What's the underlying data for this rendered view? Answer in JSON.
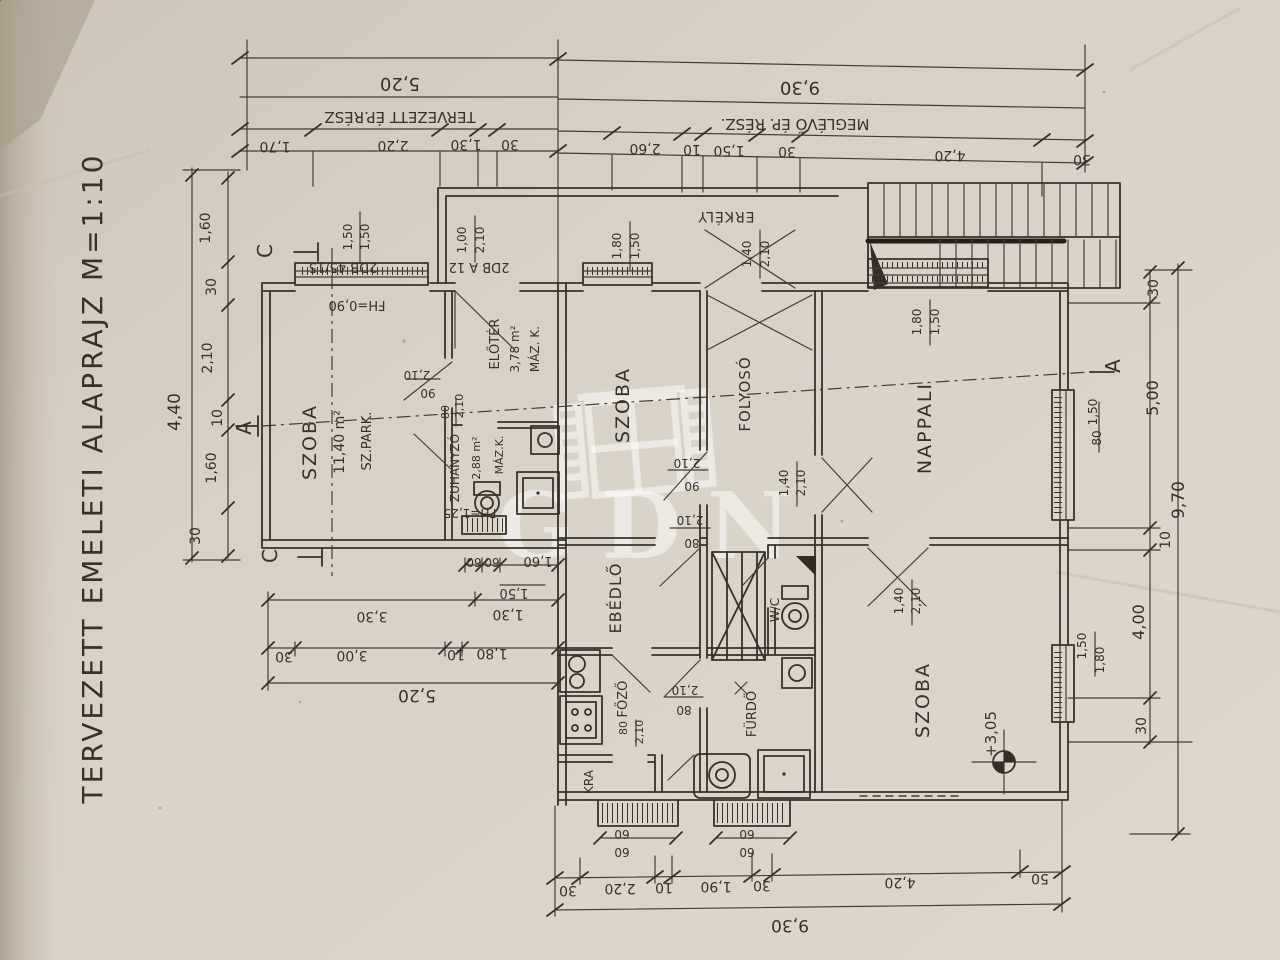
{
  "photo": {
    "title": "TERVEZETT EMELETI ALAPRAJZ M=1:10",
    "watermark_text": "GDN",
    "ink_color": "#38312a",
    "paper_color": "#d8d1c6"
  },
  "plan_summary": {
    "drawing_title": "TERVEZETT EMELETI ALAPRAJZ",
    "scale": "M=1:10",
    "building_sections": {
      "new": "TERVEZETT ÉP.RÉSZ",
      "existing": "MEGLÉVŐ ÉP. RÉSZ."
    },
    "rooms": [
      {
        "name": "SZOBA",
        "area": "11,40 m²",
        "floor": "SZ.PARK."
      },
      {
        "name": "ELŐTÉR",
        "area": "3,78 m²",
        "floor": "MÁZ. K."
      },
      {
        "name": "ZUHANYZÓ",
        "area": "2,88 m²",
        "floor": "MÁZ.K.",
        "note": "FH=1,25"
      },
      {
        "name": "SZOBA"
      },
      {
        "name": "FOLYOSÓ"
      },
      {
        "name": "NAPPALI"
      },
      {
        "name": "EBÉDLŐ"
      },
      {
        "name": "FŐZŐ"
      },
      {
        "name": "KRA"
      },
      {
        "name": "FÜRDŐ"
      },
      {
        "name": "W/C"
      },
      {
        "name": "SZOBA",
        "level_mark": "+3,05"
      },
      {
        "name": "ERKÉLY"
      }
    ],
    "overall_dimensions": {
      "top_new_part": "5,20",
      "top_existing_part": "9,30",
      "bottom": "9,30",
      "left": "4,40",
      "right": "9,70",
      "lower_left": "5,20"
    },
    "window_notes": [
      "2DB 45/15",
      "2DB A 12",
      "FH=0,90"
    ]
  },
  "labels": [
    {
      "id": "drawing-title",
      "text": "TERVEZETT EMELETI ALAPRAJZ M=1:10",
      "x": 102,
      "y": 478,
      "rot": -90,
      "size": 28,
      "ls": 3
    },
    {
      "id": "dim-top-total-new",
      "text": "5,20",
      "x": 400,
      "y": 78,
      "rot": 180,
      "size": 18
    },
    {
      "id": "dim-top-total-old",
      "text": "9,30",
      "x": 800,
      "y": 82,
      "rot": 180,
      "size": 18
    },
    {
      "id": "label-new-part",
      "text": "TERVEZETT ÉP.RÉSZ",
      "x": 400,
      "y": 112,
      "rot": 180,
      "size": 15
    },
    {
      "id": "label-old-part",
      "text": "MEGLÉVŐ ÉP. RÉSZ.",
      "x": 795,
      "y": 119,
      "rot": 180,
      "size": 15
    },
    {
      "id": "dim-top-1",
      "text": "1,70",
      "x": 275,
      "y": 142,
      "rot": 180,
      "size": 14
    },
    {
      "id": "dim-top-2",
      "text": "2,20",
      "x": 393,
      "y": 141,
      "rot": 180,
      "size": 14
    },
    {
      "id": "dim-top-3",
      "text": "1,30",
      "x": 466,
      "y": 140,
      "rot": 180,
      "size": 14
    },
    {
      "id": "dim-top-4",
      "text": "30",
      "x": 510,
      "y": 140,
      "rot": 180,
      "size": 14
    },
    {
      "id": "dim-top-5",
      "text": "2,60",
      "x": 645,
      "y": 144,
      "rot": 180,
      "size": 14
    },
    {
      "id": "dim-top-6",
      "text": "10",
      "x": 692,
      "y": 145,
      "rot": 180,
      "size": 14
    },
    {
      "id": "dim-top-7",
      "text": "1,50",
      "x": 729,
      "y": 146,
      "rot": 180,
      "size": 14
    },
    {
      "id": "dim-top-8",
      "text": "30",
      "x": 787,
      "y": 147,
      "rot": 180,
      "size": 14
    },
    {
      "id": "dim-top-9",
      "text": "4,20",
      "x": 950,
      "y": 151,
      "rot": 180,
      "size": 14
    },
    {
      "id": "dim-top-10",
      "text": "30",
      "x": 1082,
      "y": 155,
      "rot": 180,
      "size": 14
    },
    {
      "id": "dim-bot-1",
      "text": "30",
      "x": 568,
      "y": 886,
      "rot": 180,
      "size": 14
    },
    {
      "id": "dim-bot-2",
      "text": "2,20",
      "x": 620,
      "y": 884,
      "rot": 180,
      "size": 14
    },
    {
      "id": "dim-bot-3",
      "text": "10",
      "x": 664,
      "y": 883,
      "rot": 180,
      "size": 14
    },
    {
      "id": "dim-bot-4",
      "text": "1,90",
      "x": 716,
      "y": 882,
      "rot": 180,
      "size": 14
    },
    {
      "id": "dim-bot-5",
      "text": "30",
      "x": 762,
      "y": 881,
      "rot": 180,
      "size": 14
    },
    {
      "id": "dim-bot-6",
      "text": "4,20",
      "x": 900,
      "y": 878,
      "rot": 180,
      "size": 14
    },
    {
      "id": "dim-bot-7",
      "text": "50",
      "x": 1040,
      "y": 874,
      "rot": 180,
      "size": 14
    },
    {
      "id": "dim-bot-total",
      "text": "9,30",
      "x": 790,
      "y": 920,
      "rot": 180,
      "size": 17
    },
    {
      "id": "dim-left-1",
      "text": "1,60",
      "x": 210,
      "y": 228,
      "rot": -90,
      "size": 14
    },
    {
      "id": "dim-left-2",
      "text": "30",
      "x": 216,
      "y": 287,
      "rot": -90,
      "size": 14
    },
    {
      "id": "dim-left-3",
      "text": "2,10",
      "x": 212,
      "y": 358,
      "rot": -90,
      "size": 14
    },
    {
      "id": "dim-left-4",
      "text": "10",
      "x": 222,
      "y": 418,
      "rot": -90,
      "size": 14
    },
    {
      "id": "dim-left-5",
      "text": "1,60",
      "x": 216,
      "y": 468,
      "rot": -90,
      "size": 14
    },
    {
      "id": "dim-left-6",
      "text": "30",
      "x": 200,
      "y": 536,
      "rot": -90,
      "size": 14
    },
    {
      "id": "dim-left-total",
      "text": "4,40",
      "x": 180,
      "y": 412,
      "rot": -90,
      "size": 17
    },
    {
      "id": "dim-ll-1",
      "text": "60",
      "x": 474,
      "y": 558,
      "rot": 180,
      "size": 12
    },
    {
      "id": "dim-ll-2",
      "text": "60",
      "x": 492,
      "y": 558,
      "rot": 180,
      "size": 12
    },
    {
      "id": "dim-ll-3",
      "text": "1,60",
      "x": 538,
      "y": 557,
      "rot": 180,
      "size": 13
    },
    {
      "id": "dim-ll-4",
      "text": "1,50",
      "x": 514,
      "y": 589,
      "rot": 180,
      "size": 13
    },
    {
      "id": "dim-ll-5",
      "text": "3,30",
      "x": 372,
      "y": 612,
      "rot": 180,
      "size": 14
    },
    {
      "id": "dim-ll-6",
      "text": "1,30",
      "x": 508,
      "y": 610,
      "rot": 180,
      "size": 14
    },
    {
      "id": "dim-ll-7",
      "text": "30",
      "x": 284,
      "y": 652,
      "rot": 180,
      "size": 14
    },
    {
      "id": "dim-ll-8",
      "text": "3,00",
      "x": 352,
      "y": 651,
      "rot": 180,
      "size": 14
    },
    {
      "id": "dim-ll-9",
      "text": "10",
      "x": 456,
      "y": 650,
      "rot": 180,
      "size": 14
    },
    {
      "id": "dim-ll-10",
      "text": "1,80",
      "x": 492,
      "y": 649,
      "rot": 180,
      "size": 14
    },
    {
      "id": "dim-ll-total",
      "text": "5,20",
      "x": 417,
      "y": 690,
      "rot": 180,
      "size": 17
    },
    {
      "id": "dim-right-1",
      "text": "30",
      "x": 1158,
      "y": 288,
      "rot": -90,
      "size": 14
    },
    {
      "id": "dim-right-2",
      "text": "5,00",
      "x": 1158,
      "y": 398,
      "rot": -90,
      "size": 16
    },
    {
      "id": "dim-right-total",
      "text": "9,70",
      "x": 1184,
      "y": 500,
      "rot": -90,
      "size": 17
    },
    {
      "id": "dim-right-3",
      "text": "10",
      "x": 1170,
      "y": 540,
      "rot": -90,
      "size": 14
    },
    {
      "id": "dim-right-4",
      "text": "4,00",
      "x": 1144,
      "y": 622,
      "rot": -90,
      "size": 16
    },
    {
      "id": "dim-right-5",
      "text": "30",
      "x": 1146,
      "y": 726,
      "rot": -90,
      "size": 14
    },
    {
      "id": "section-marker-c-top",
      "text": "C",
      "x": 272,
      "y": 251,
      "rot": -90,
      "size": 20
    },
    {
      "id": "section-marker-c-bottom",
      "text": "C",
      "x": 277,
      "y": 556,
      "rot": -90,
      "size": 20
    },
    {
      "id": "section-marker-a-left",
      "text": "A",
      "x": 251,
      "y": 428,
      "rot": -90,
      "size": 20
    },
    {
      "id": "section-marker-a-right",
      "text": "A",
      "x": 1120,
      "y": 366,
      "rot": -90,
      "size": 20
    },
    {
      "id": "window-note-1",
      "text": "2DB 45/15",
      "x": 343,
      "y": 263,
      "rot": 180,
      "size": 13
    },
    {
      "id": "window-1-w",
      "text": "1,50",
      "x": 352,
      "y": 237,
      "rot": -90,
      "size": 12
    },
    {
      "id": "window-1-h",
      "text": "1,50",
      "x": 369,
      "y": 237,
      "rot": -90,
      "size": 12
    },
    {
      "id": "parapet-note",
      "text": "FH=0,90",
      "x": 357,
      "y": 301,
      "rot": 180,
      "size": 13
    },
    {
      "id": "window-note-2",
      "text": "2DB A 12",
      "x": 479,
      "y": 263,
      "rot": 180,
      "size": 13
    },
    {
      "id": "door-entry-w",
      "text": "1,00",
      "x": 466,
      "y": 240,
      "rot": -90,
      "size": 12
    },
    {
      "id": "door-entry-h",
      "text": "2,10",
      "x": 484,
      "y": 240,
      "rot": -90,
      "size": 12
    },
    {
      "id": "window-2-w",
      "text": "1,80",
      "x": 621,
      "y": 246,
      "rot": -90,
      "size": 12
    },
    {
      "id": "window-2-h",
      "text": "1,50",
      "x": 639,
      "y": 246,
      "rot": -90,
      "size": 12
    },
    {
      "id": "room-erkely",
      "text": "ERKÉLY",
      "x": 726,
      "y": 212,
      "rot": 180,
      "size": 14,
      "ls": 1
    },
    {
      "id": "door-balcony-w",
      "text": "1,40",
      "x": 751,
      "y": 254,
      "rot": -90,
      "size": 12
    },
    {
      "id": "door-balcony-h",
      "text": "2,10",
      "x": 769,
      "y": 254,
      "rot": -90,
      "size": 12
    },
    {
      "id": "window-3-w",
      "text": "1,80",
      "x": 921,
      "y": 322,
      "rot": -90,
      "size": 12
    },
    {
      "id": "window-3-h",
      "text": "1,50",
      "x": 939,
      "y": 322,
      "rot": -90,
      "size": 12
    },
    {
      "id": "window-4-w",
      "text": "1,50",
      "x": 1097,
      "y": 412,
      "rot": -90,
      "size": 12
    },
    {
      "id": "window-4-h",
      "text": "80",
      "x": 1101,
      "y": 438,
      "rot": -90,
      "size": 12
    },
    {
      "id": "window-5-w",
      "text": "1,50",
      "x": 1086,
      "y": 646,
      "rot": -90,
      "size": 12
    },
    {
      "id": "window-5-h",
      "text": "1,80",
      "x": 1104,
      "y": 660,
      "rot": -90,
      "size": 12
    },
    {
      "id": "room-szoba-new",
      "text": "SZOBA",
      "x": 316,
      "y": 442,
      "rot": -90,
      "size": 19,
      "ls": 2
    },
    {
      "id": "room-szoba-new-area",
      "text": "11,40 m²",
      "x": 344,
      "y": 442,
      "rot": -90,
      "size": 14
    },
    {
      "id": "room-szoba-new-floor",
      "text": "SZ.PARK.",
      "x": 371,
      "y": 441,
      "rot": -90,
      "size": 13
    },
    {
      "id": "room-eloter",
      "text": "ELŐTÉR",
      "x": 499,
      "y": 344,
      "rot": -90,
      "size": 13
    },
    {
      "id": "room-eloter-area",
      "text": "3,78 m²",
      "x": 519,
      "y": 349,
      "rot": -90,
      "size": 12
    },
    {
      "id": "room-eloter-floor",
      "text": "MÁZ. K.",
      "x": 539,
      "y": 349,
      "rot": -90,
      "size": 12
    },
    {
      "id": "room-zuhanyzo",
      "text": "ZUHANYZÓ",
      "x": 459,
      "y": 468,
      "rot": -90,
      "size": 12
    },
    {
      "id": "room-zuhanyzo-area",
      "text": "2,88 m²",
      "x": 480,
      "y": 458,
      "rot": -90,
      "size": 11
    },
    {
      "id": "room-zuhanyzo-floor",
      "text": "MÁZ.K.",
      "x": 503,
      "y": 455,
      "rot": -90,
      "size": 11
    },
    {
      "id": "note-fh125",
      "text": "FH=1,25",
      "x": 470,
      "y": 509,
      "rot": 180,
      "size": 12
    },
    {
      "id": "room-szoba-mid",
      "text": "SZOBA",
      "x": 629,
      "y": 405,
      "rot": -90,
      "size": 19,
      "ls": 2
    },
    {
      "id": "room-folyoso",
      "text": "FOLYOSÓ",
      "x": 750,
      "y": 394,
      "rot": -90,
      "size": 15,
      "ls": 1
    },
    {
      "id": "room-nappali",
      "text": "NAPPALI",
      "x": 931,
      "y": 428,
      "rot": -90,
      "size": 19,
      "ls": 2
    },
    {
      "id": "room-ebedlo",
      "text": "EBÉDLŐ",
      "x": 621,
      "y": 598,
      "rot": -90,
      "size": 16,
      "ls": 1
    },
    {
      "id": "room-fozo",
      "text": "FŐZŐ",
      "x": 627,
      "y": 699,
      "rot": -90,
      "size": 13
    },
    {
      "id": "room-kra",
      "text": "KRA",
      "x": 593,
      "y": 782,
      "rot": -90,
      "size": 12
    },
    {
      "id": "room-furdo",
      "text": "FÜRDŐ",
      "x": 756,
      "y": 714,
      "rot": -90,
      "size": 13
    },
    {
      "id": "room-wc",
      "text": "W/C",
      "x": 779,
      "y": 610,
      "rot": -90,
      "size": 12
    },
    {
      "id": "room-szoba-bottom",
      "text": "SZOBA",
      "x": 929,
      "y": 700,
      "rot": -90,
      "size": 19,
      "ls": 2
    },
    {
      "id": "level-mark-value",
      "text": "+3,05",
      "x": 996,
      "y": 734,
      "rot": -90,
      "size": 15
    },
    {
      "id": "door-1-h",
      "text": "2,10",
      "x": 417,
      "y": 371,
      "rot": 180,
      "size": 12
    },
    {
      "id": "door-1-w",
      "text": "90",
      "x": 428,
      "y": 389,
      "rot": 180,
      "size": 12
    },
    {
      "id": "door-2-w",
      "text": "80",
      "x": 449,
      "y": 412,
      "rot": -90,
      "size": 11
    },
    {
      "id": "door-2-h",
      "text": "2,10",
      "x": 463,
      "y": 406,
      "rot": -90,
      "size": 11
    },
    {
      "id": "door-3-h",
      "text": "2,10",
      "x": 687,
      "y": 459,
      "rot": 180,
      "size": 12
    },
    {
      "id": "door-3-w",
      "text": "90",
      "x": 692,
      "y": 482,
      "rot": 180,
      "size": 12
    },
    {
      "id": "door-4-h",
      "text": "2,10",
      "x": 690,
      "y": 516,
      "rot": 180,
      "size": 12
    },
    {
      "id": "door-4-w",
      "text": "80",
      "x": 692,
      "y": 539,
      "rot": 180,
      "size": 12
    },
    {
      "id": "door-5-w",
      "text": "1,40",
      "x": 788,
      "y": 483,
      "rot": -90,
      "size": 12
    },
    {
      "id": "door-5-h",
      "text": "2,10",
      "x": 805,
      "y": 483,
      "rot": -90,
      "size": 12
    },
    {
      "id": "door-6-h",
      "text": "2,10",
      "x": 685,
      "y": 686,
      "rot": 180,
      "size": 12
    },
    {
      "id": "door-6-w",
      "text": "80",
      "x": 684,
      "y": 706,
      "rot": 180,
      "size": 12
    },
    {
      "id": "door-7-w",
      "text": "80",
      "x": 627,
      "y": 728,
      "rot": -90,
      "size": 11
    },
    {
      "id": "door-7-h",
      "text": "2,10",
      "x": 643,
      "y": 732,
      "rot": -90,
      "size": 11
    },
    {
      "id": "door-8-w",
      "text": "1,40",
      "x": 903,
      "y": 601,
      "rot": -90,
      "size": 12
    },
    {
      "id": "door-8-h",
      "text": "2,10",
      "x": 920,
      "y": 601,
      "rot": -90,
      "size": 12
    },
    {
      "id": "dim-rad-1a",
      "text": "60",
      "x": 622,
      "y": 830,
      "rot": 180,
      "size": 12
    },
    {
      "id": "dim-rad-1b",
      "text": "60",
      "x": 622,
      "y": 848,
      "rot": 180,
      "size": 12
    },
    {
      "id": "dim-rad-2a",
      "text": "60",
      "x": 747,
      "y": 830,
      "rot": 180,
      "size": 12
    },
    {
      "id": "dim-rad-2b",
      "text": "60",
      "x": 747,
      "y": 848,
      "rot": 180,
      "size": 12
    }
  ]
}
